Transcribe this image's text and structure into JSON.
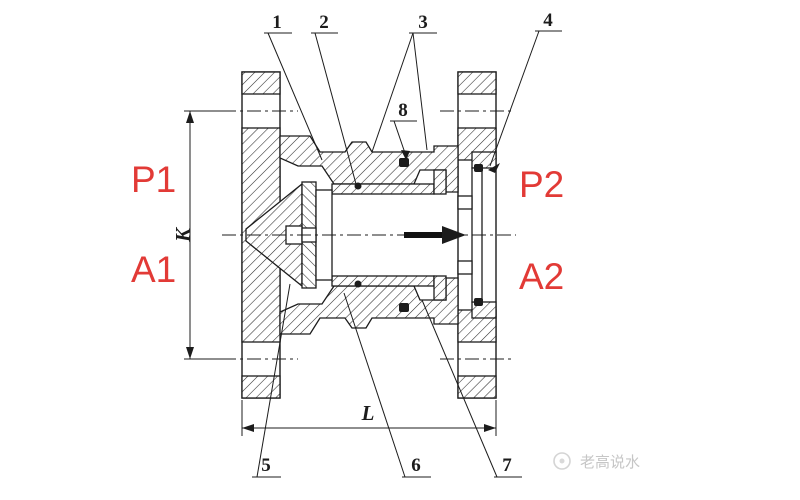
{
  "drawing": {
    "description": "Cross-section engineering drawing of a flanged check valve with flow arrow",
    "port_labels": {
      "top_left": "P1",
      "bottom_left": "A1",
      "top_right": "P2",
      "bottom_right": "A2"
    },
    "dimension_labels": {
      "vertical": "K",
      "horizontal": "L"
    },
    "callouts": [
      "1",
      "2",
      "3",
      "4",
      "5",
      "6",
      "7",
      "8"
    ],
    "flow_direction": "right",
    "watermark": {
      "text": "老高说水",
      "icon": "circle-logo"
    },
    "colors": {
      "port_label_red": "#e23a36",
      "line_black": "#1c1c1c",
      "watermark_gray": "#c6c6c6",
      "paper_white": "#ffffff"
    }
  }
}
